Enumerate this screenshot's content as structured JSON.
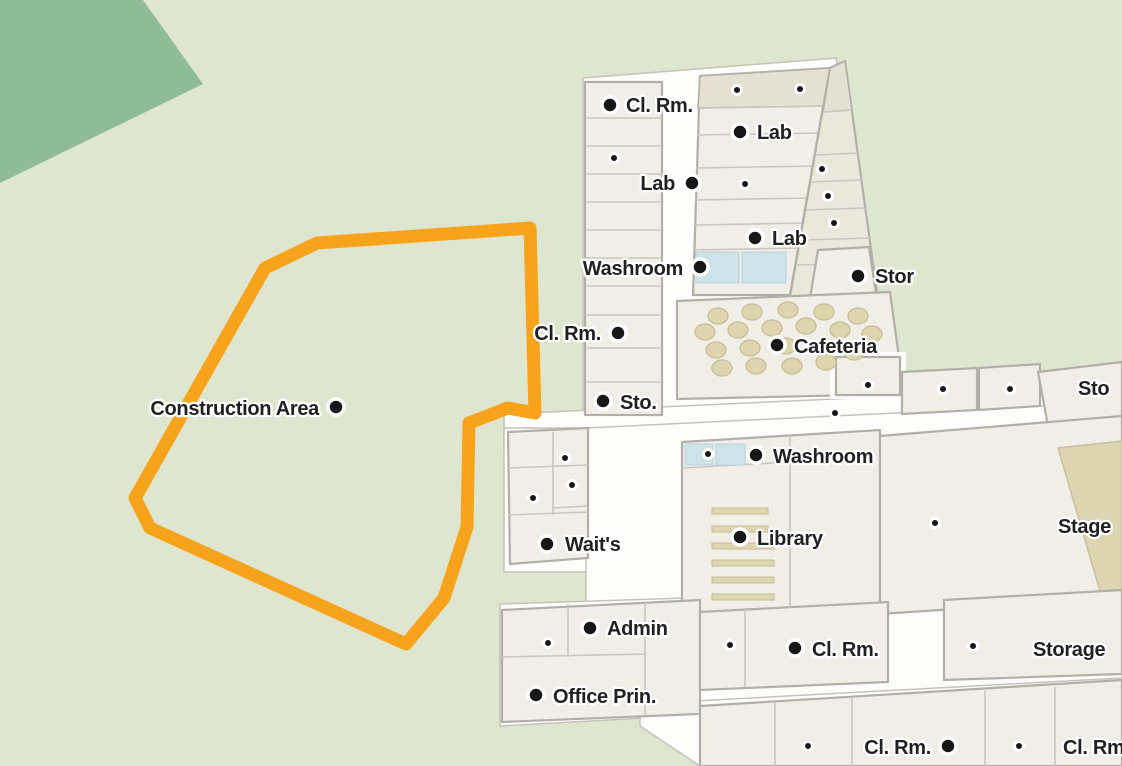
{
  "map": {
    "colors": {
      "background": "#dfe6d0",
      "terrain_patch": "#8fbc96",
      "room_light": "#f0eee7",
      "room_dark": "#e4e1d2",
      "corridor": "#fdfdfb",
      "wall": "#b2afa7",
      "washroom_tile": "#cde3ea",
      "furniture": "#ddd4b0",
      "marker": "#171717",
      "label_text": "#212121",
      "label_halo": "#ffffff",
      "construction_outline": "#f7a41c"
    },
    "construction_area": {
      "label": "Construction Area",
      "outline_color": "#f7a41c",
      "points": [
        [
          317,
          243
        ],
        [
          530,
          228
        ],
        [
          535,
          413
        ],
        [
          508,
          408
        ],
        [
          469,
          423
        ],
        [
          467,
          527
        ],
        [
          444,
          598
        ],
        [
          406,
          644
        ],
        [
          150,
          528
        ],
        [
          135,
          498
        ],
        [
          265,
          268
        ]
      ]
    },
    "labels": [
      {
        "id": "cl-rm-1",
        "text": "Cl. Rm.",
        "anchor": "start",
        "tx": 626,
        "ty": 112,
        "dot": [
          610,
          105
        ]
      },
      {
        "id": "lab-1",
        "text": "Lab",
        "anchor": "start",
        "tx": 757,
        "ty": 139,
        "dot": [
          740,
          132
        ]
      },
      {
        "id": "lab-2",
        "text": "Lab",
        "anchor": "end",
        "tx": 675,
        "ty": 190,
        "dot": [
          692,
          183
        ]
      },
      {
        "id": "lab-3",
        "text": "Lab",
        "anchor": "start",
        "tx": 772,
        "ty": 245,
        "dot": [
          755,
          238
        ]
      },
      {
        "id": "washroom-1",
        "text": "Washroom",
        "anchor": "end",
        "tx": 683,
        "ty": 275,
        "dot": [
          700,
          267
        ]
      },
      {
        "id": "stor-1",
        "text": "Stor",
        "anchor": "start",
        "tx": 875,
        "ty": 283,
        "dot": [
          858,
          276
        ]
      },
      {
        "id": "cl-rm-2",
        "text": "Cl. Rm.",
        "anchor": "end",
        "tx": 601,
        "ty": 340,
        "dot": [
          618,
          333
        ]
      },
      {
        "id": "cafeteria",
        "text": "Cafeteria",
        "anchor": "start",
        "tx": 794,
        "ty": 353,
        "dot": [
          777,
          345
        ]
      },
      {
        "id": "sto-1",
        "text": "Sto.",
        "anchor": "start",
        "tx": 620,
        "ty": 409,
        "dot": [
          603,
          401
        ]
      },
      {
        "id": "sto-2",
        "text": "Sto",
        "anchor": "start",
        "tx": 1078,
        "ty": 395,
        "dot": null
      },
      {
        "id": "construction-area",
        "text": "Construction Area",
        "anchor": "end",
        "tx": 319,
        "ty": 415,
        "dot": [
          336,
          407
        ]
      },
      {
        "id": "washroom-2",
        "text": "Washroom",
        "anchor": "start",
        "tx": 773,
        "ty": 463,
        "dot": [
          756,
          455
        ]
      },
      {
        "id": "library",
        "text": "Library",
        "anchor": "start",
        "tx": 757,
        "ty": 545,
        "dot": [
          740,
          537
        ]
      },
      {
        "id": "stage",
        "text": "Stage",
        "anchor": "start",
        "tx": 1058,
        "ty": 533,
        "dot": null
      },
      {
        "id": "waits",
        "text": "Wait's",
        "anchor": "start",
        "tx": 565,
        "ty": 551,
        "dot": [
          547,
          544
        ]
      },
      {
        "id": "admin",
        "text": "Admin",
        "anchor": "start",
        "tx": 607,
        "ty": 635,
        "dot": [
          590,
          628
        ]
      },
      {
        "id": "cl-rm-3",
        "text": "Cl. Rm.",
        "anchor": "start",
        "tx": 812,
        "ty": 656,
        "dot": [
          795,
          648
        ]
      },
      {
        "id": "storage",
        "text": "Storage",
        "anchor": "start",
        "tx": 1033,
        "ty": 656,
        "dot": null
      },
      {
        "id": "office-prin",
        "text": "Office Prin.",
        "anchor": "start",
        "tx": 553,
        "ty": 703,
        "dot": [
          536,
          695
        ]
      },
      {
        "id": "cl-rm-4",
        "text": "Cl. Rm.",
        "anchor": "end",
        "tx": 931,
        "ty": 754,
        "dot": [
          948,
          746
        ]
      },
      {
        "id": "cl-rm-5",
        "text": "Cl. Rm.",
        "anchor": "start",
        "tx": 1063,
        "ty": 754,
        "dot": null
      }
    ],
    "small_dots": [
      [
        737,
        90
      ],
      [
        800,
        89
      ],
      [
        614,
        158
      ],
      [
        745,
        184
      ],
      [
        822,
        169
      ],
      [
        828,
        196
      ],
      [
        834,
        223
      ],
      [
        868,
        385
      ],
      [
        943,
        389
      ],
      [
        1010,
        389
      ],
      [
        835,
        413
      ],
      [
        565,
        458
      ],
      [
        708,
        454
      ],
      [
        572,
        485
      ],
      [
        533,
        498
      ],
      [
        935,
        523
      ],
      [
        548,
        643
      ],
      [
        730,
        645
      ],
      [
        973,
        646
      ],
      [
        808,
        746
      ],
      [
        1019,
        746
      ]
    ],
    "cafeteria_tables": [
      [
        718,
        316
      ],
      [
        752,
        312
      ],
      [
        788,
        310
      ],
      [
        824,
        312
      ],
      [
        858,
        316
      ],
      [
        705,
        332
      ],
      [
        738,
        330
      ],
      [
        772,
        328
      ],
      [
        806,
        326
      ],
      [
        840,
        330
      ],
      [
        872,
        334
      ],
      [
        716,
        350
      ],
      [
        750,
        348
      ],
      [
        786,
        346
      ],
      [
        854,
        352
      ],
      [
        722,
        368
      ],
      [
        756,
        366
      ],
      [
        792,
        366
      ],
      [
        826,
        362
      ]
    ]
  }
}
